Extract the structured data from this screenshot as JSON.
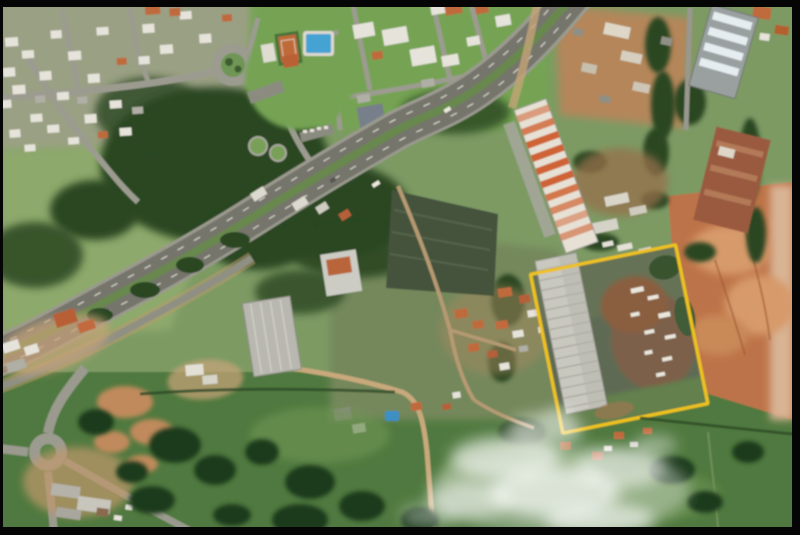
{
  "scene": {
    "kind": "aerial-satellite-photo",
    "subject": "Suburban and industrial district crossed by a divided highway; one industrial parcel outlined in yellow; smoke plume over pasture",
    "frame_color": "#050505"
  },
  "annotation": {
    "name": "parcel-boundary",
    "shape": "rotated-rectangle",
    "color": "#eec11e"
  },
  "palette": {
    "field_green": "#7d9a64",
    "lawn_green": "#74a352",
    "pasture_green": "#50793f",
    "forest_green": "#2a4723",
    "road_gray": "#9a9a8e",
    "asphalt_gray": "#74746c",
    "median_green": "#68884e",
    "lane_marking": "#e2e2d8",
    "bare_soil": "#bd7348",
    "dirt_tan": "#c8a97c",
    "roof_orange": "#bf6a3c",
    "roof_white": "#e6e3da",
    "roof_gray": "#b9b8b0",
    "roof_rust": "#9a5a40",
    "pool_blue": "#44a3d4",
    "court_orange": "#c06a38",
    "smoke_white": "#ffffff"
  }
}
